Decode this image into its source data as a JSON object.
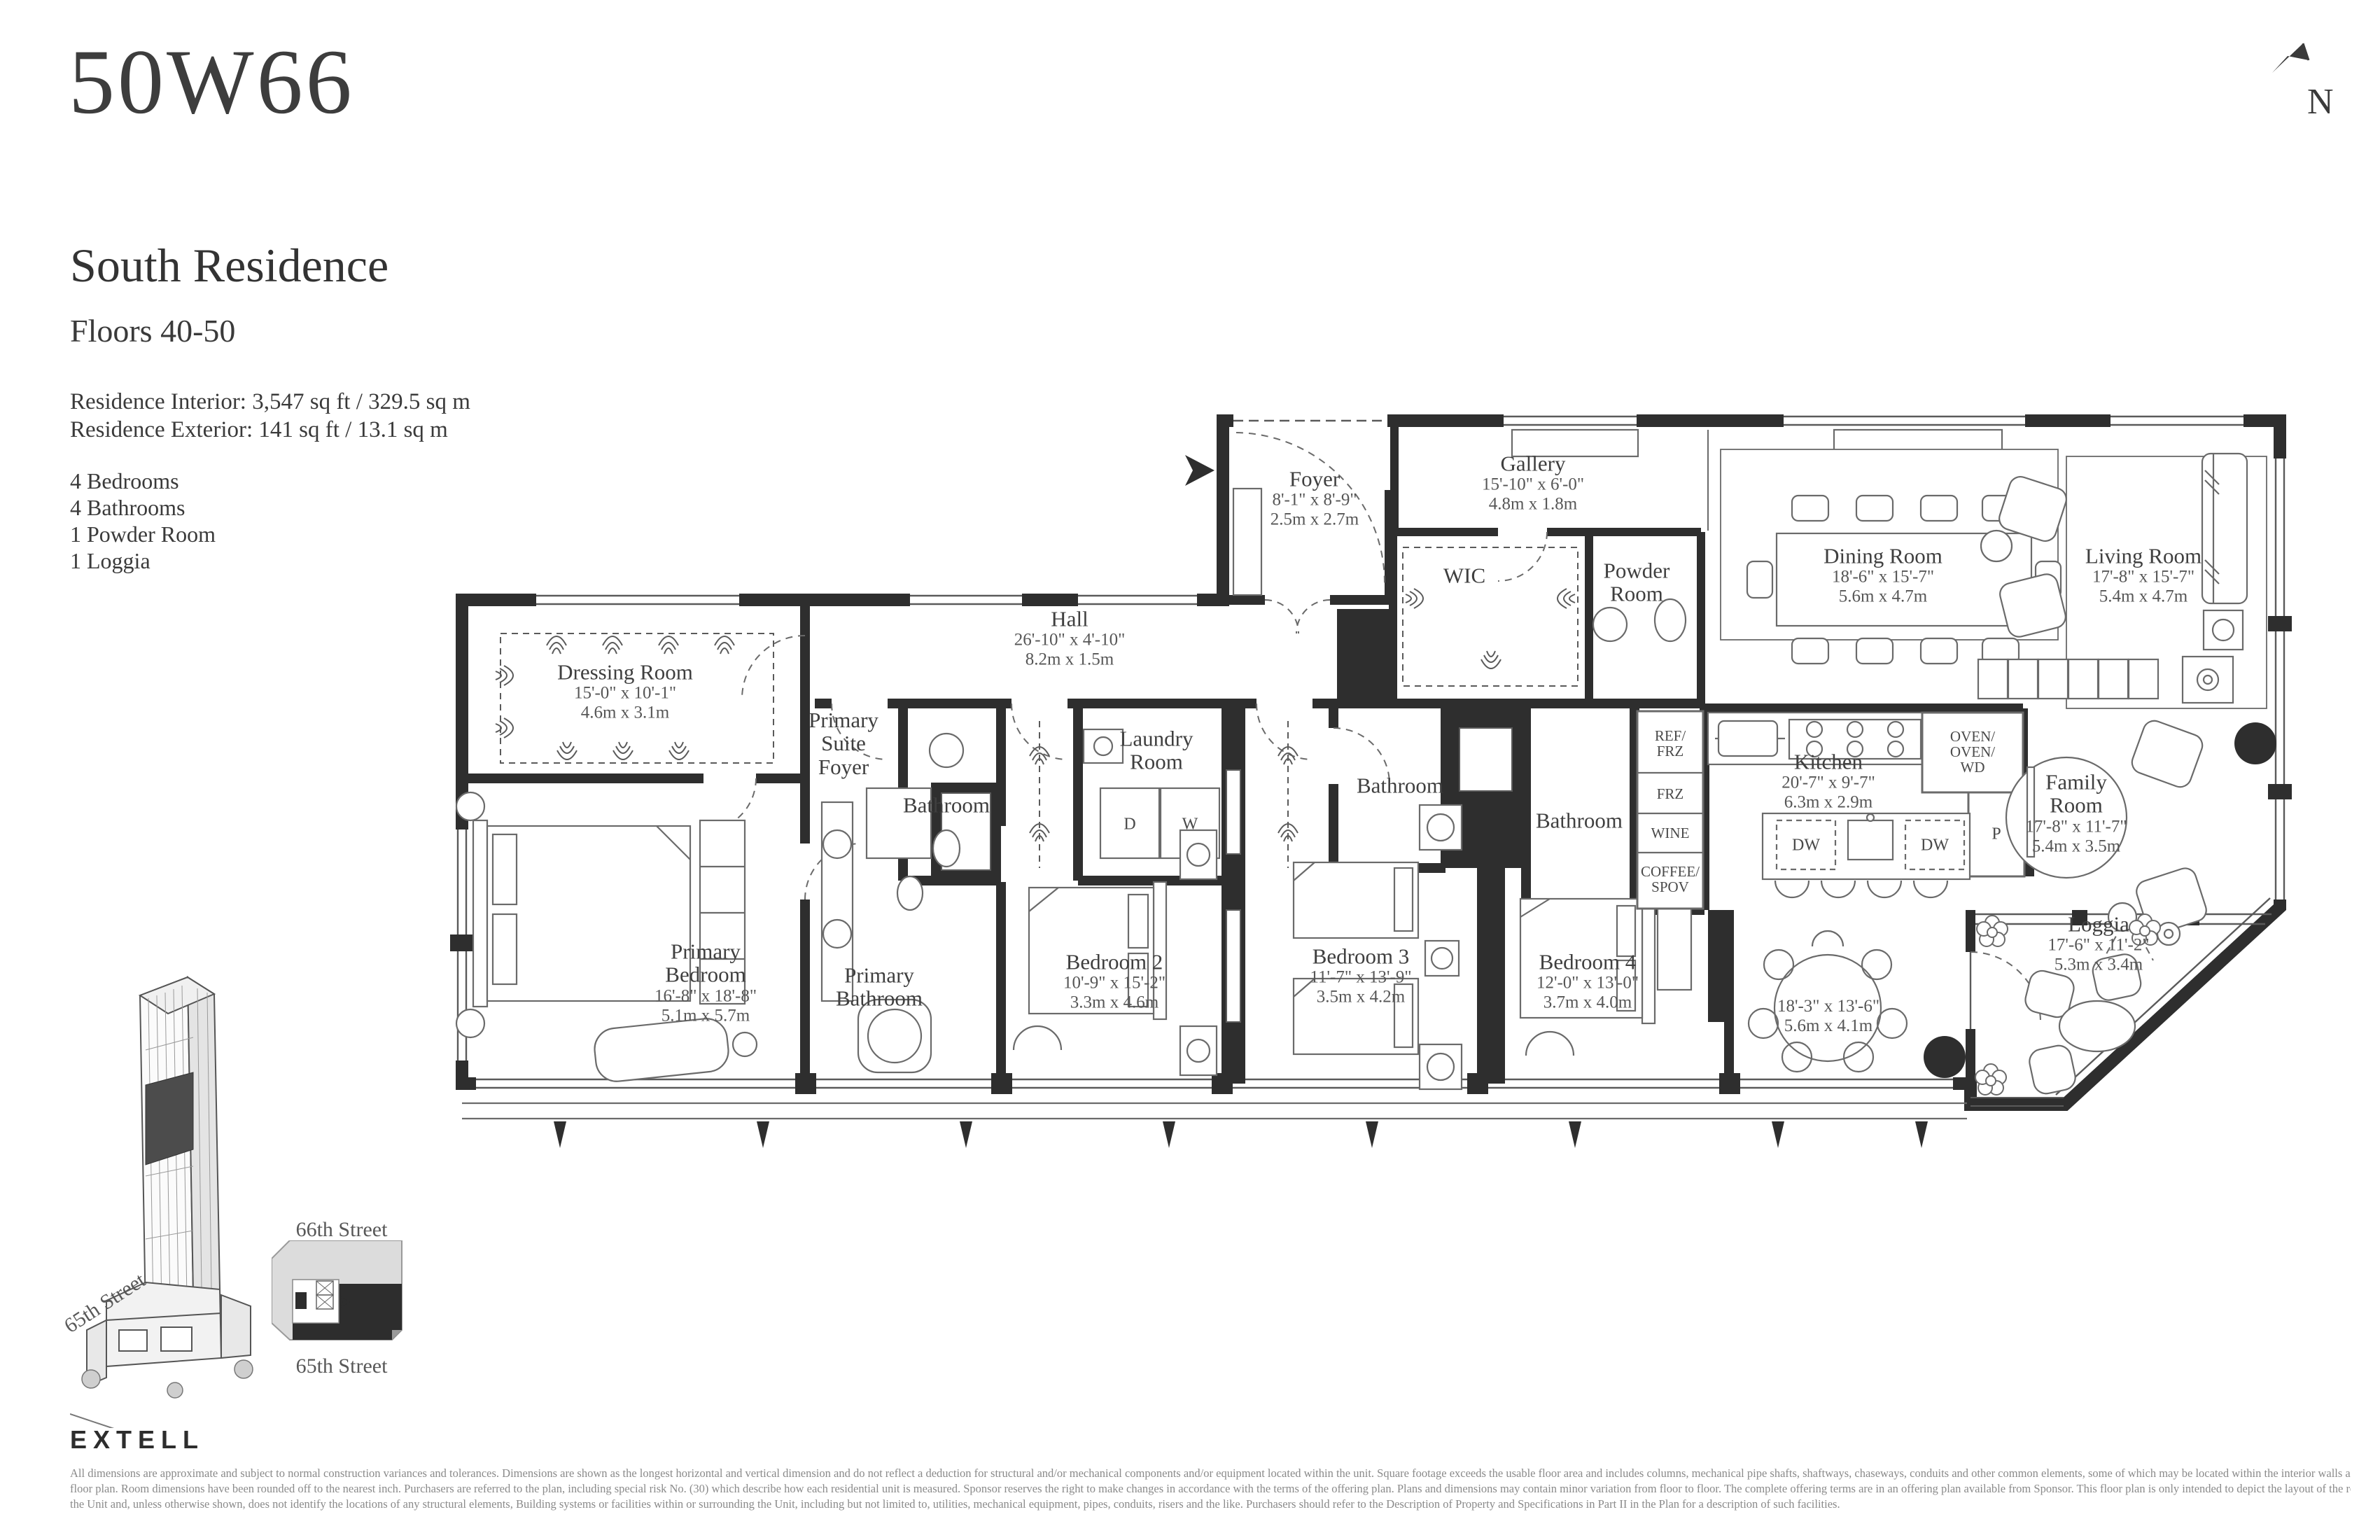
{
  "header": {
    "logo": "50W66",
    "title": "South Residence",
    "subtitle": "Floors 40-50",
    "interior": "Residence Interior: 3,547 sq ft / 329.5 sq m",
    "exterior": "Residence Exterior: 141 sq ft / 13.1 sq m",
    "features": [
      "4 Bedrooms",
      "4 Bathrooms",
      "1 Powder Room",
      "1 Loggia"
    ]
  },
  "compass": {
    "label": "N"
  },
  "rooms": {
    "foyer": {
      "name": "Foyer",
      "ft": "8'-1\" x 8'-9\"",
      "m": "2.5m x 2.7m"
    },
    "gallery": {
      "name": "Gallery",
      "ft": "15'-10\" x 6'-0\"",
      "m": "4.8m x 1.8m"
    },
    "wic": {
      "name": "WIC"
    },
    "powder": {
      "name": "Powder\nRoom"
    },
    "dining": {
      "name": "Dining Room",
      "ft": "18'-6\" x 15'-7\"",
      "m": "5.6m x 4.7m"
    },
    "living": {
      "name": "Living Room",
      "ft": "17'-8\" x 15'-7\"",
      "m": "5.4m x 4.7m"
    },
    "dressing": {
      "name": "Dressing Room",
      "ft": "15'-0\" x 10'-1\"",
      "m": "4.6m x 3.1m"
    },
    "primary_suite_foyer": {
      "name": "Primary\nSuite\nFoyer"
    },
    "hall": {
      "name": "Hall",
      "ft": "26'-10\" x 4'-10\"",
      "m": "8.2m x 1.5m"
    },
    "laundry": {
      "name": "Laundry\nRoom"
    },
    "bath_hall": {
      "name": "Bathroom"
    },
    "bath3": {
      "name": "Bathroom"
    },
    "bath4": {
      "name": "Bathroom"
    },
    "kitchen": {
      "name": "Kitchen",
      "ft": "20'-7\" x 9'-7\"",
      "m": "6.3m x 2.9m"
    },
    "family": {
      "name": "Family\nRoom",
      "ft": "17'-8\" x 11'-7\"",
      "m": "5.4m x 3.5m"
    },
    "primary_bedroom": {
      "name": "Primary\nBedroom",
      "ft": "16'-8\" x 18'-8\"",
      "m": "5.1m x 5.7m"
    },
    "primary_bath": {
      "name": "Primary\nBathroom"
    },
    "bed2": {
      "name": "Bedroom 2",
      "ft": "10'-9\" x 15'-2\"",
      "m": "3.3m x 4.6m"
    },
    "bed3": {
      "name": "Bedroom 3",
      "ft": "11'-7\" x 13'-9\"",
      "m": "3.5m x 4.2m"
    },
    "bed4": {
      "name": "Bedroom 4",
      "ft": "12'-0\" x 13'-0\"",
      "m": "3.7m x 4.0m"
    },
    "breakfast": {
      "ft": "18'-3\" x 13'-6\"",
      "m": "5.6m x 4.1m"
    },
    "loggia": {
      "name": "Loggia",
      "ft": "17'-6\" x 11'-2\"",
      "m": "5.3m x 3.4m"
    }
  },
  "appliances": {
    "ref": "REF/\nFRZ",
    "frz": "FRZ",
    "wine": "WINE",
    "coffee": "COFFEE/\nSPOV",
    "oven": "OVEN/\nOVEN/\nWD",
    "dw1": "DW",
    "dw2": "DW",
    "d": "D",
    "w": "W",
    "p": "P"
  },
  "site": {
    "street_top": "66th Street",
    "street_bottom": "65th Street",
    "street_corner": "65th Street"
  },
  "footer": {
    "brand": "EXTELL",
    "disclaimer": [
      "All dimensions are approximate and subject to normal construction variances and tolerances. Dimensions are shown as the longest horizontal and vertical dimension and do not reflect a deduction for structural and/or mechanical components and/or equipment located within the unit. Square footage exceeds the usable floor area and includes columns, mechanical pipe shafts, shaftways, chaseways, conduits and other common elements, some of which may be located within the interior walls and are not shown on this",
      "floor plan.  Room dimensions have been rounded off to the nearest inch. Purchasers are referred to the plan, including special risk No. (30) which describe how each residential unit is measured. Sponsor reserves the right to make changes in accordance with the terms of the offering plan. Plans and dimensions may contain minor variation from floor to floor. The complete offering terms are in an offering plan available from Sponsor. This floor plan is only intended to depict the layout of the rooms and spaces within",
      "the Unit and, unless otherwise shown, does not identify the locations of any structural elements, Building systems or facilities within or surrounding the Unit, including but not limited to, utilities, mechanical equipment, pipes, conduits, risers and the like. Purchasers should refer to the Description of Property and Specifications in Part II in the Plan for a description of such facilities."
    ]
  }
}
